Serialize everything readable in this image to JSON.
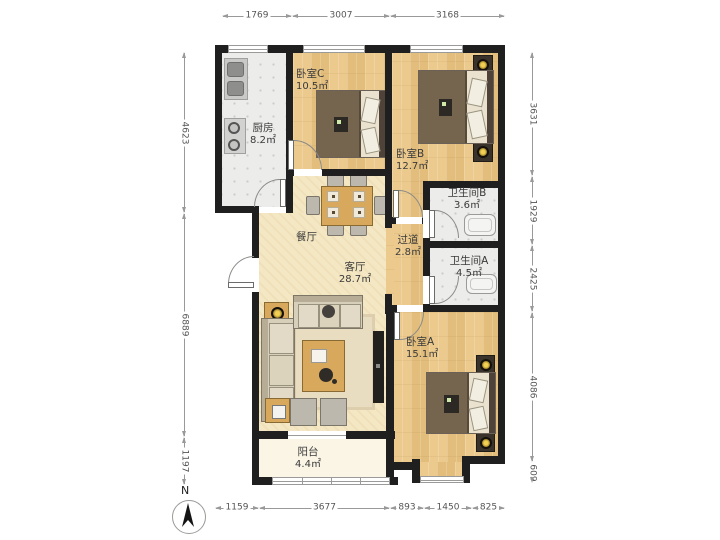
{
  "plan_type": "apartment-floor-plan",
  "compass": {
    "label": "N"
  },
  "rooms": {
    "kitchen": {
      "name": "厨房",
      "area": "8.2㎡"
    },
    "bedroom_c": {
      "name": "卧室C",
      "area": "10.5㎡"
    },
    "bedroom_b": {
      "name": "卧室B",
      "area": "12.7㎡"
    },
    "bathroom_b": {
      "name": "卫生间B",
      "area": "3.6㎡"
    },
    "hallway": {
      "name": "过道",
      "area": "2.8㎡"
    },
    "bathroom_a": {
      "name": "卫生间A",
      "area": "4.5㎡"
    },
    "bedroom_a": {
      "name": "卧室A",
      "area": "15.1㎡"
    },
    "dining": {
      "name": "餐厅",
      "area": ""
    },
    "living": {
      "name": "客厅",
      "area": "28.7㎡"
    },
    "balcony": {
      "name": "阳台",
      "area": "4.4㎡"
    }
  },
  "dimensions_mm": {
    "top": [
      "1769",
      "3007",
      "3168"
    ],
    "left": [
      "4623",
      "6889",
      "1197"
    ],
    "right": [
      "3631",
      "1929",
      "2425",
      "4086",
      "609"
    ],
    "bottom": [
      "1159",
      "3677",
      "893",
      "1450",
      "825"
    ]
  },
  "colors": {
    "wall": "#1f1f1f",
    "wood_floor": "#e6c385",
    "tile_floor": "#ececea",
    "living_floor": "#f4e7c3",
    "balcony_floor": "#faf5e5",
    "lamp_gold": "#f0cf52",
    "dim_line": "#999999"
  }
}
